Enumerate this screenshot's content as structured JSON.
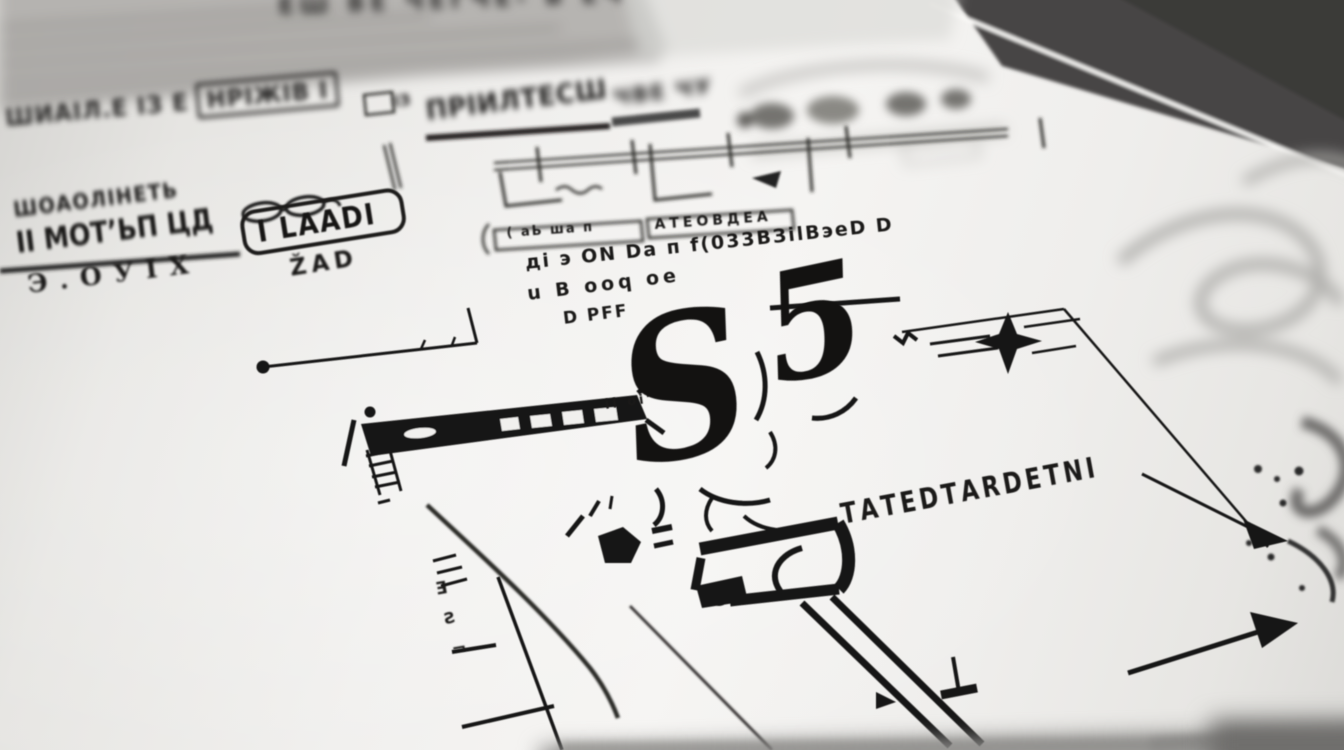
{
  "colors": {
    "paper": "#f3f2f0",
    "ink": "#171615",
    "table": "#464544",
    "soft_gray": "#aeadaa"
  },
  "texts": {
    "top_edge": "ЕШ ВЕ ЧЕГЧЕ- В ЕЧ",
    "left_row1a": "ШИАІЛ.Е ІЗ Е",
    "left_row1b": "НРІЖІВ І",
    "left_row2": "ШОАОЛІНЕТЬ",
    "left_row3": "ІІ МОТ’ЬП ЦД",
    "left_row4": "Э.ОУІХ",
    "stamp": "І LААDІ",
    "stamp_sub": "ŽAD",
    "header_prefix": "ІЗ",
    "header": "ПРІИЛТЕСШ",
    "header_right": "ЧВЕ ЧУ",
    "tab_left": "( аЬ ша п",
    "tab_right": "АТЕОВДЕА",
    "note1": "ді э ОN Dа п f(033ВЗіlВэеD D",
    "note2": "u В ооq ое",
    "note3": "D РFF",
    "small_marks": "іl оі’",
    "hero_s": "S",
    "hero_five": "5",
    "caption": "ТАТЕDТАRDЕТNІ",
    "col_glyphs": [
      "Ǝ",
      "Ƨ",
      "¬"
    ]
  },
  "icons": {
    "sparkle": "four-point-star",
    "arrow_right": "hand-drawn-arrow",
    "arrow_up_right": "hand-drawn-arrow",
    "glasses_doodle": "double-ellipse"
  }
}
